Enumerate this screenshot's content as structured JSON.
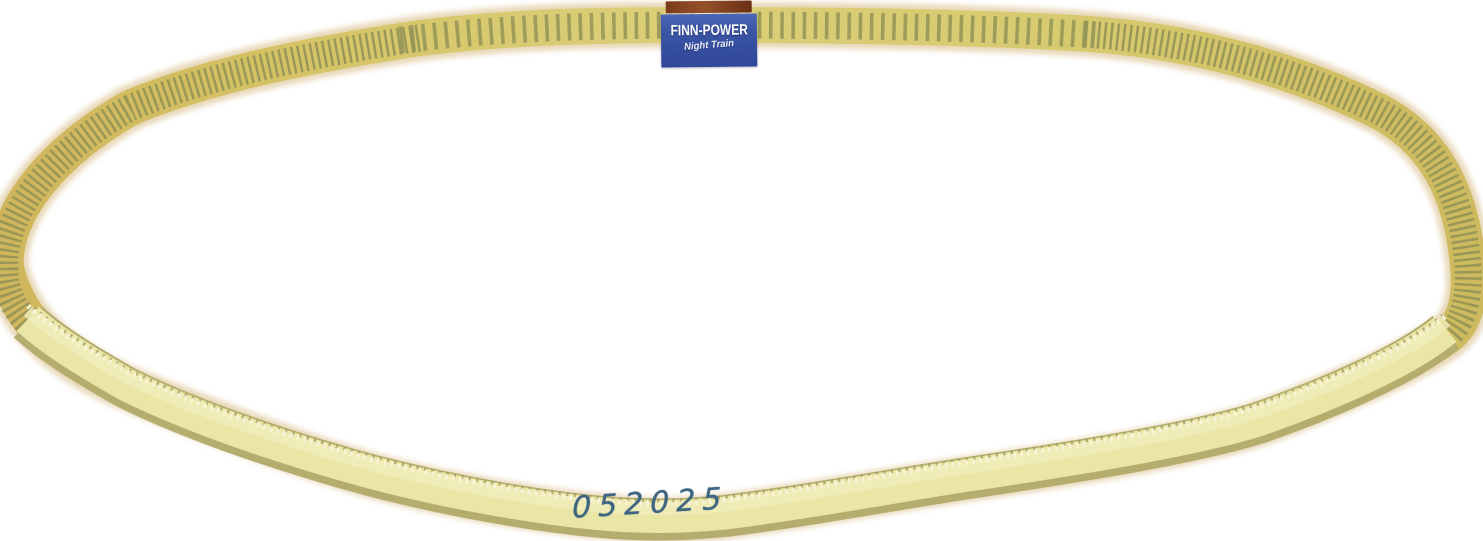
{
  "scene": {
    "type": "product photograph",
    "subject": "Yellow toothed timing belt loop with manufacturer label, lying on a white background",
    "background": "#ffffff"
  },
  "colors": {
    "belt-yellow": "#d9cb6e",
    "belt-gold": "#d2b95c",
    "tooth-groove": "#8f9155",
    "belt-back": "#e9e6a6",
    "belt-back-edge": "#b4ad6e",
    "belt-back-serration": "#f7f4d6",
    "belt-halo": "#d5b87f",
    "label-blue": "#3a54a4",
    "label-strip-brown": "#7c3a1c",
    "label-text": "#ffffff",
    "marking-ink": "#3d6480"
  },
  "label": {
    "brand": "FINN-POWER",
    "tagline": "Night Train"
  },
  "belt": {
    "handwritten_marking": "052025"
  }
}
